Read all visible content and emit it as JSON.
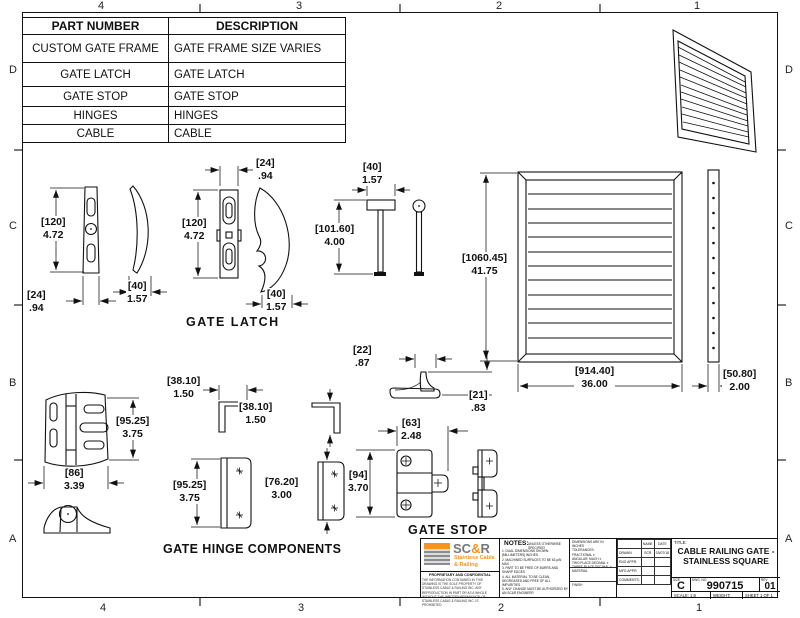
{
  "sheet": {
    "zone_cols": [
      "4",
      "3",
      "2",
      "1"
    ],
    "zone_rows": [
      "D",
      "C",
      "B",
      "A"
    ]
  },
  "parts_table": {
    "col1_header": "PART NUMBER",
    "col2_header": "DESCRIPTION",
    "rows": [
      {
        "part": "CUSTOM GATE FRAME",
        "desc": "GATE FRAME SIZE VARIES"
      },
      {
        "part": "GATE LATCH",
        "desc": "GATE LATCH"
      },
      {
        "part": "GATE STOP",
        "desc": "GATE STOP"
      },
      {
        "part": "HINGES",
        "desc": "HINGES"
      },
      {
        "part": "CABLE",
        "desc": "CABLE"
      }
    ]
  },
  "section_labels": {
    "gate_latch": "GATE  LATCH",
    "gate_hinge_components": "GATE HINGE COMPONENTS",
    "gate_stop": "GATE STOP"
  },
  "dims": {
    "latch_handle_height": {
      "mm": "[120]",
      "in": "4.72"
    },
    "latch_handle_width": {
      "mm": "[24]",
      "in": ".94"
    },
    "latch_handle_thickness": {
      "mm": "[40]",
      "in": "1.57"
    },
    "latch_body_width": {
      "mm": "[24]",
      "in": ".94"
    },
    "latch_body_height": {
      "mm": "[120]",
      "in": "4.72"
    },
    "latch_hook_thickness": {
      "mm": "[40]",
      "in": "1.57"
    },
    "pin_head_width": {
      "mm": "[40]",
      "in": "1.57"
    },
    "pin_height": {
      "mm": "[101.60]",
      "in": "4.00"
    },
    "gate_height": {
      "mm": "[1060.45]",
      "in": "41.75"
    },
    "gate_width": {
      "mm": "[914.40]",
      "in": "36.00"
    },
    "gate_thickness": {
      "mm": "[50.80]",
      "in": "2.00"
    },
    "bracket1_width": {
      "mm": "[38.10]",
      "in": "1.50"
    },
    "bracket2_height": {
      "mm": "[38.10]",
      "in": "1.50"
    },
    "hinge_height": {
      "mm": "[95.25]",
      "in": "3.75"
    },
    "hinge_width": {
      "mm": "[86]",
      "in": "3.39"
    },
    "plate1_height": {
      "mm": "[95.25]",
      "in": "3.75"
    },
    "plate2_height": {
      "mm": "[76.20]",
      "in": "3.00"
    },
    "stop_profile_width": {
      "mm": "[22]",
      "in": ".87"
    },
    "stop_profile_height": {
      "mm": "[21]",
      "in": ".83"
    },
    "stop_width": {
      "mm": "[63]",
      "in": "2.48"
    },
    "stop_height": {
      "mm": "[94]",
      "in": "3.70"
    }
  },
  "title_block": {
    "logo": {
      "brand_sc": "SC",
      "brand_amp": "&",
      "brand_r": "R",
      "tagline1": "Stainless Cable",
      "tagline2": "& Railing",
      "proprietary_heading": "PROPRIETARY AND CONFIDENTIAL",
      "proprietary_text": "THE INFORMATION CONTAINED IN THIS DRAWING IS THE SOLE PROPERTY OF STAINLESS CABLE & RAILING INC. ANY REPRODUCTION IN PART OR AS A WHOLE WITHOUT THE WRITTEN PERMISSION OF STAINLESS CABLE & RAILING INC. IS PROHIBITED."
    },
    "notes": {
      "heading": "NOTES:",
      "qualifier": "UNLESS OTHERWISE SPECIFIED",
      "items": [
        "1. DUAL DIMENSIONS SHOWN: [MILLIMETERS] INCHES",
        "2. MACHINED SURFACES TO BE 63 µIN MAX",
        "3. PART TO BE FREE OF BURRS AND SHARP EDGES",
        "4. ALL MATERIAL TO BE CLEAN, DEGREASED AND FREE OF ALL IMPURITIES",
        "5. ANY CHANGE MUST BE AUTHORIZED BY AN SC&R ENGINEER"
      ]
    },
    "tolerances": {
      "line1": "DIMENSIONS ARE IN INCHES",
      "line2": "TOLERANCES:",
      "line3": "FRACTIONAL ±",
      "line4": "ANGULAR: MACH ±",
      "line5": "TWO PLACE DECIMAL ±",
      "line6": "THREE PLACE DECIMAL ±",
      "material_label": "MATERIAL",
      "finish_label": "FINISH"
    },
    "approvals": {
      "name_header": "NAME",
      "date_header": "DATE",
      "drawn_label": "DRAWN",
      "drawn_name": "SCR",
      "drawn_date": "03/07/18",
      "eng_label": "ENG APPR.",
      "mfg_label": "MFG APPR.",
      "comments_label": "COMMENTS:"
    },
    "title_label": "TITLE:",
    "title_line1": "CABLE RAILING GATE -",
    "title_line2": "STAINLESS SQUARE",
    "size_label": "SIZE",
    "size_value": "C",
    "dwg_label": "DWG.  NO.",
    "dwg_number": "990715",
    "rev_label": "REV",
    "rev_value": "01",
    "scale_text": "SCALE: 1:8",
    "weight_text": "WEIGHT:",
    "sheet_text": "SHEET 1 OF 1"
  },
  "colors": {
    "accent_orange": "#F7941D",
    "logo_gray": "#77787B",
    "line": "#111111"
  }
}
